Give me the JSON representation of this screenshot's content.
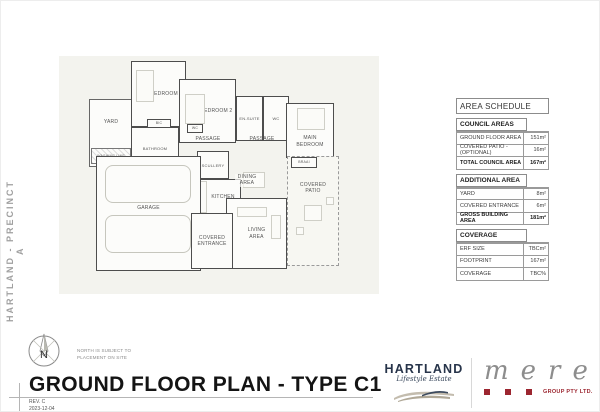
{
  "colors": {
    "plan_background": "#f3f3ee",
    "wall": "#4d4d4d",
    "hartland_navy": "#27344a",
    "mere_red": "#9c2630",
    "mere_grey": "#8d8d8d"
  },
  "sidebar": {
    "project_label": "HARTLAND - PRECINCT A"
  },
  "plan": {
    "rooms": {
      "yard": "YARD",
      "bedroom1": "BEDROOM 1",
      "bedroom2": "BEDROOM 2",
      "bathroom": "BATHROOM",
      "ensuite": "EN-SUITE",
      "wc": "WC",
      "wc_small": "WC",
      "bic": "BIC",
      "main_bedroom": "MAIN BEDROOM",
      "passage_a": "PASSAGE",
      "passage_b": "PASSAGE",
      "scullery": "SCULLERY",
      "kitchen": "KITCHEN",
      "garage": "GARAGE",
      "dining": "DINING AREA",
      "living": "LIVING AREA",
      "entrance": "COVERED ENTRANCE",
      "patio": "COVERED PATIO",
      "braai": "BRAAI",
      "washing_line": "WASHING LINE"
    }
  },
  "area_schedule": {
    "title": "AREA SCHEDULE",
    "sections": [
      {
        "header": "COUNCIL AREAS",
        "rows": [
          {
            "label": "GROUND FLOOR AREA",
            "value": "151m²"
          },
          {
            "label": "COVERED PATIO -(OPTIONAL)",
            "value": "16m²"
          },
          {
            "label": "TOTAL COUNCIL AREA",
            "value": "167m²"
          }
        ]
      },
      {
        "header": "ADDITIONAL AREA",
        "rows": [
          {
            "label": "YARD",
            "value": "8m²"
          },
          {
            "label": "COVERED ENTRANCE",
            "value": "6m²"
          },
          {
            "label": "GROSS BUILDING AREA",
            "value": "181m²"
          }
        ]
      },
      {
        "header": "COVERAGE",
        "rows": [
          {
            "label": "ERF SIZE",
            "value": "TBCm²"
          },
          {
            "label": "FOOTPRINT",
            "value": "167m²"
          },
          {
            "label": "COVERAGE",
            "value": "TBC%"
          }
        ]
      }
    ]
  },
  "title_block": {
    "title": "GROUND FLOOR PLAN - TYPE C1",
    "revision": "REV.  C",
    "revision_date": "2023-12-04",
    "compass_letter": "N",
    "north_note_line1": "NORTH IS SUBJECT TO",
    "north_note_line2": "PLACEMENT ON SITE"
  },
  "logos": {
    "hartland": {
      "name": "HARTLAND",
      "tagline": "Lifestyle Estate"
    },
    "mere": {
      "name": "mere",
      "subtext": "GROUP PTY LTD."
    }
  }
}
